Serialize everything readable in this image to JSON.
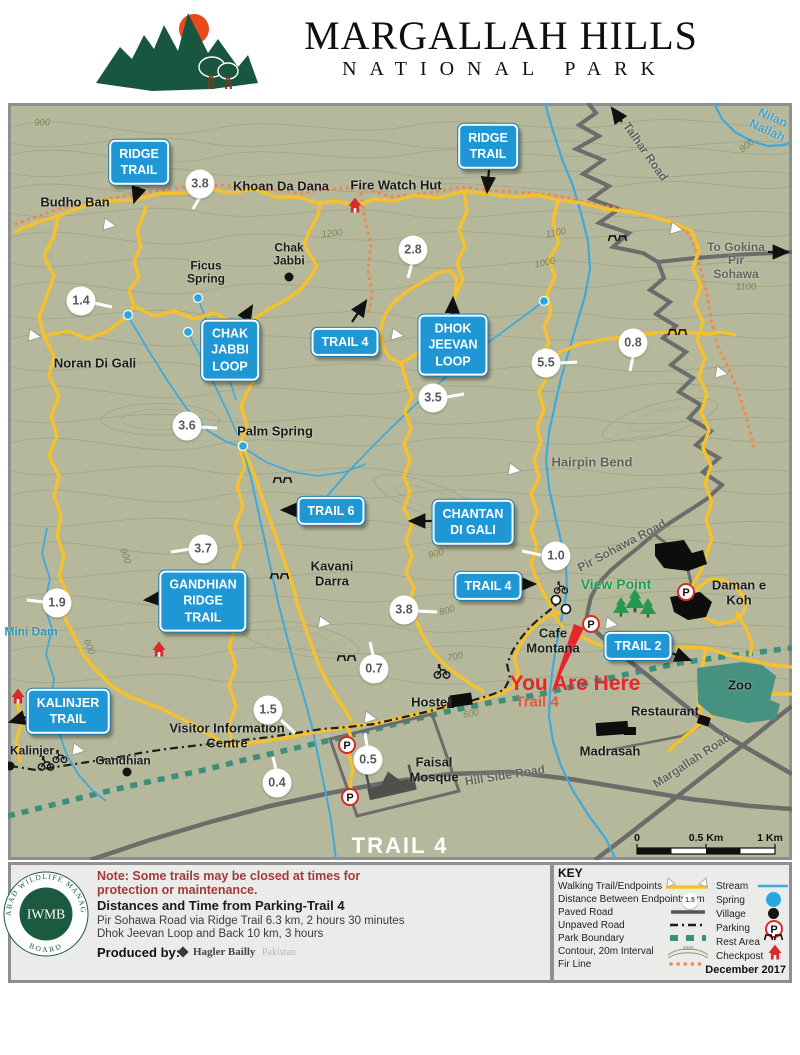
{
  "header": {
    "title": "MARGALLAH HILLS",
    "subtitle": "NATIONAL PARK"
  },
  "map": {
    "signs": {
      "ridge_trail_1": "RIDGE\nTRAIL",
      "ridge_trail_2": "RIDGE\nTRAIL",
      "chak_jabbi_loop": "CHAK\nJABBI\nLOOP",
      "trail_4_top": "TRAIL 4",
      "dhok_jeevan_loop": "DHOK\nJEEVAN\nLOOP",
      "trail_6": "TRAIL 6",
      "chantan_di_gali": "CHANTAN\nDI GALI",
      "trail_4_mid": "TRAIL 4",
      "gandhian_ridge_trail": "GANDHIAN\nRIDGE\nTRAIL",
      "kalinjer_trail": "KALINJER\nTRAIL",
      "trail_2": "TRAIL 2"
    },
    "distances": [
      "3.8",
      "2.8",
      "1.4",
      "0.8",
      "5.5",
      "3.5",
      "3.6",
      "3.7",
      "1.9",
      "1.0",
      "3.8",
      "0.7",
      "1.5",
      "0.5",
      "0.4"
    ],
    "places": {
      "budho_ban": "Budho Ban",
      "khoan_da_dana": "Khoan Da Dana",
      "fire_watch_hut": "Fire Watch Hut",
      "chak_jabbi": "Chak\nJabbi",
      "ficus_spring": "Ficus\nSpring",
      "noran_di_gali": "Noran Di Gali",
      "palm_spring": "Palm Spring",
      "hairpin_bend": "Hairpin Bend",
      "kavani_darra": "Kavani\nDarra",
      "mini_dam": "Mini Dam",
      "visitor_information_centre": "Visitor Information\nCentre",
      "kalinjer": "Kalinjer",
      "gandhian": "Gandhian",
      "hostel": "Hostel",
      "cafe_montana": "Cafe\nMontana",
      "view_point": "View Point",
      "daman_e_koh": "Daman e Koh",
      "restaurant": "Restaurant",
      "madrasah": "Madrasah",
      "faisal_mosque": "Faisal\nMosque",
      "zoo": "Zoo",
      "you_are_here": "You Are Here",
      "you_are_here_sub": "Trail 4",
      "to_gokina": "To Gokina\nPir Sohawa",
      "nilan_nallah": "Nilan Nallah",
      "talhar_road": "Talhar Road",
      "pir_sohawa_road": "Pir Sohawa Road",
      "hill_side_road": "Hill Side Road",
      "margallah_road": "Margallah Road",
      "trail_4_banner": "TRAIL 4"
    },
    "contour_labels": [
      "900",
      "1200",
      "1100",
      "1000",
      "1100",
      "900",
      "900",
      "600",
      "900",
      "800",
      "700",
      "600"
    ],
    "scale": {
      "zero": "0",
      "half": "0.5 Km",
      "one": "1 Km"
    },
    "icons": {
      "parking_letter": "P"
    }
  },
  "footer": {
    "seal": {
      "org_top": "ISLAMABAD WILDLIFE MANAGEMENT",
      "org_bottom": "BOARD",
      "abbr": "IWMB"
    },
    "note": "Note: Some trails may be closed at times for\nprotection or maintenance.",
    "distances_title": "Distances and Time from Parking-Trail 4",
    "distance_line1": "Pir Sohawa Road via Ridge Trail 6.3 km, 2 hours 30 minutes",
    "distance_line2": "Dhok Jeevan Loop and Back 10 km, 3 hours",
    "produced_by": "Produced by:",
    "producer": "Hagler Bailly",
    "producer_suffix": "Pakistan",
    "key": {
      "title": "KEY",
      "left": [
        "Walking Trail/Endpoints",
        "Distance Between Endpoints, km",
        "Paved Road",
        "Unpaved Road",
        "Park Boundary",
        "Contour, 20m Interval",
        "Fir Line"
      ],
      "right": [
        "Stream",
        "Spring",
        "Village",
        "Parking",
        "Rest Area",
        "Checkpost"
      ],
      "distance_sample": "1.5",
      "contour_sample": "1000",
      "date": "December 2017"
    }
  }
}
